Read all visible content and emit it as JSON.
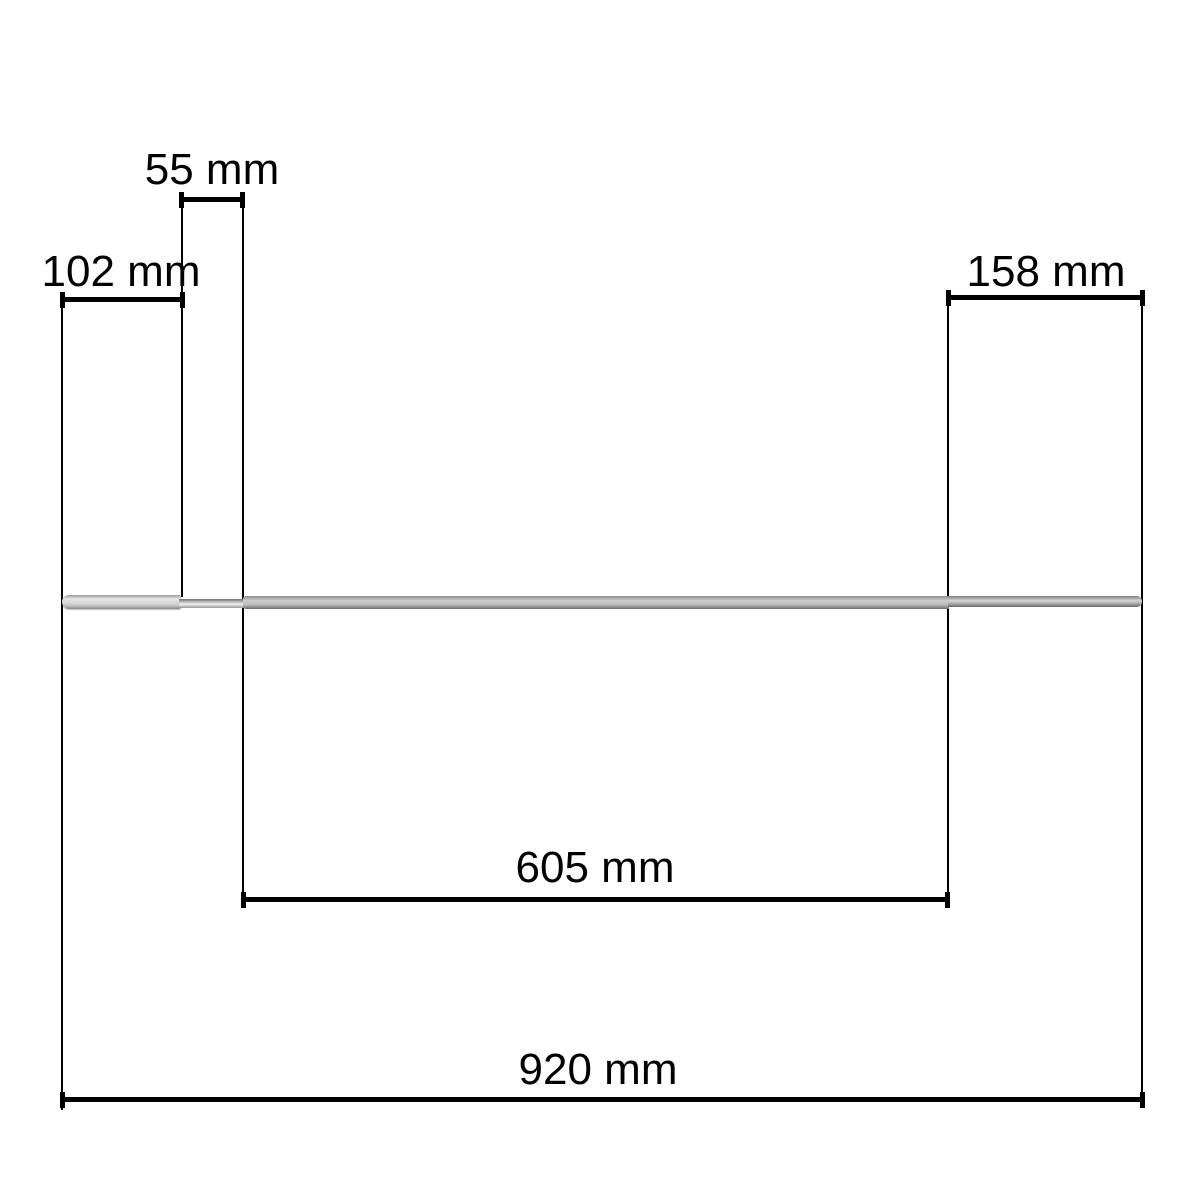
{
  "diagram": {
    "title": "skewer-rod-dimension-drawing",
    "unit": "mm",
    "dimensions": [
      {
        "id": "neck-length",
        "label": "55 mm",
        "value_mm": 55
      },
      {
        "id": "handle-length",
        "label": "102 mm",
        "value_mm": 102
      },
      {
        "id": "tip-length",
        "label": "158 mm",
        "value_mm": 158
      },
      {
        "id": "blade-length",
        "label": "605 mm",
        "value_mm": 605
      },
      {
        "id": "overall-length",
        "label": "920 mm",
        "value_mm": 920
      }
    ],
    "colors": {
      "line_color": "#000000",
      "bg_color": "#ffffff",
      "rod_light": "#e6e6e6",
      "rod_mid": "#bdbdbd",
      "rod_dark": "#6f6f6f"
    }
  }
}
